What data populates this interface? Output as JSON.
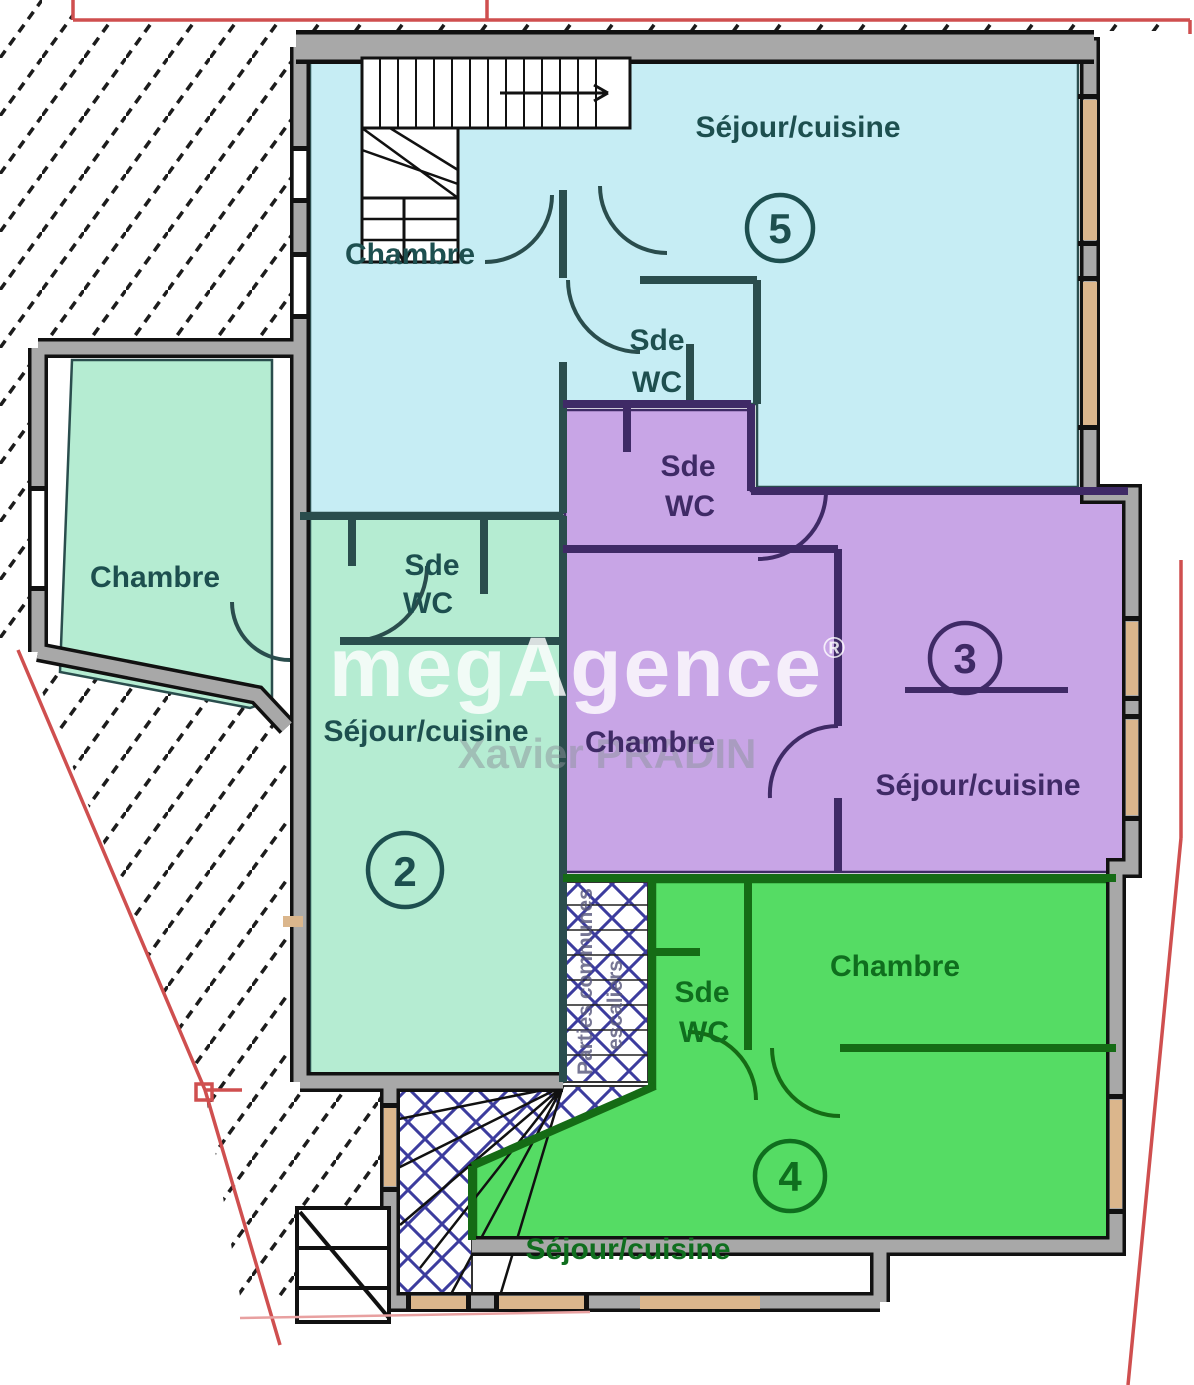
{
  "watermark": {
    "brand": "megAgence",
    "registered": "®",
    "agent": "Xavier PRADIN"
  },
  "apartments": {
    "apt5": {
      "number": "5",
      "sejour": "Séjour/cuisine",
      "chambre": "Chambre",
      "sde": "Sde",
      "wc": "WC"
    },
    "apt3": {
      "number": "3",
      "sejour": "Séjour/cuisine",
      "chambre": "Chambre",
      "sde": "Sde",
      "wc": "WC"
    },
    "apt2": {
      "number": "2",
      "sejour": "Séjour/cuisine",
      "chambre": "Chambre",
      "sde": "Sde",
      "wc": "WC"
    },
    "apt4": {
      "number": "4",
      "sejour": "Séjour/cuisine",
      "chambre": "Chambre",
      "sde": "Sde",
      "wc": "WC"
    }
  },
  "commons": {
    "line1": "Parties communes",
    "line2": "escaliers"
  },
  "colors": {
    "apartment5": "#c6edf4",
    "apartment2": "#b5ecd2",
    "apartment3": "#c8a5e6",
    "apartment4": "#55dc64",
    "wall_gray": "#a8a8a8",
    "wall_edge": "#111111",
    "boundary_red": "#cf4f4f",
    "boundary_pink": "#e8a0a0",
    "commons_hatch": "#3c3c9e",
    "neighbor_hatch": "#1c1c1c",
    "window_tan": "#dbb68c",
    "label_teal": "#1d4f4f",
    "label_purple": "#3f2a66",
    "label_green": "#0f6e1e",
    "watermark_white": "#ffffff",
    "watermark_gray": "#8c949c"
  }
}
